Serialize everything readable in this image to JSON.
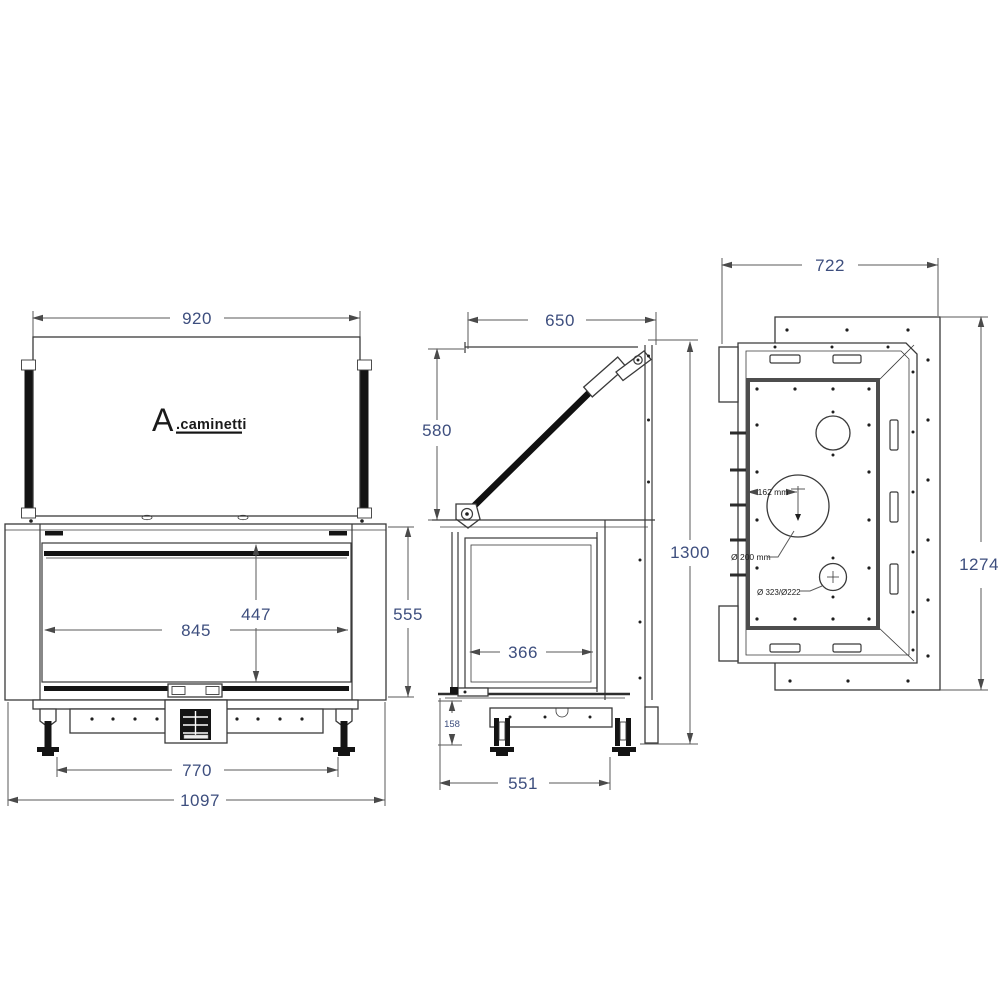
{
  "logo": {
    "prefix": "A",
    "suffix": ".caminetti"
  },
  "front_view": {
    "dim_glass_width": "920",
    "dim_opening_width": "845",
    "dim_opening_height": "447",
    "dim_front_height": "555",
    "dim_feet_spacing": "770",
    "dim_overall_width": "1097"
  },
  "side_view": {
    "dim_top_depth": "650",
    "dim_door_open_height": "580",
    "dim_total_height_door_open": "1300",
    "dim_glass_depth": "366",
    "dim_plinth_height": "158",
    "dim_base_depth": "551"
  },
  "rear_view": {
    "dim_overall_depth": "722",
    "dim_overall_height": "1274",
    "ann_flue_offset": "162 mm",
    "ann_flue_diameter": "Ø 200 mm",
    "ann_air_intake": "Ø 323/Ø222"
  }
}
